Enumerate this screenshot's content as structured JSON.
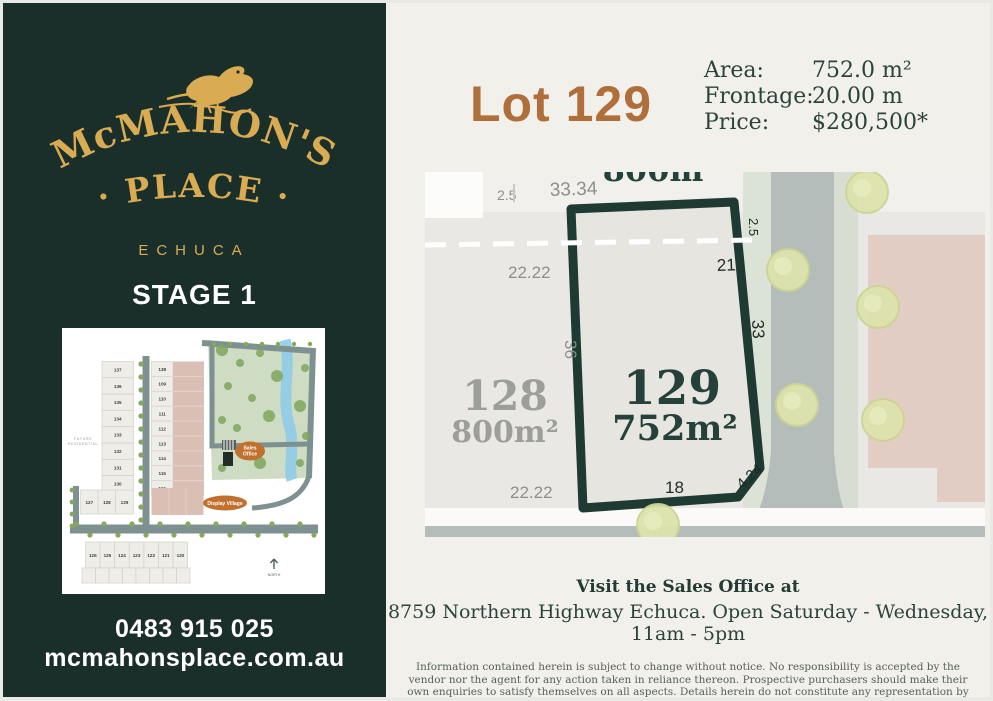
{
  "sidebar": {
    "brand": {
      "name_arc": "McMAHON'S",
      "name_line2": "· PLACE ·",
      "location": "ECHUCA"
    },
    "stage_label": "STAGE 1",
    "phone": "0483 915 025",
    "website": "mcmahonsplace.com.au",
    "minimap": {
      "left_column_lots": [
        "137",
        "136",
        "135",
        "134",
        "133",
        "132",
        "131",
        "130"
      ],
      "right_column_lots": [
        "138",
        "109",
        "110",
        "111",
        "112",
        "113",
        "114",
        "115",
        "116"
      ],
      "row_lots": [
        "127",
        "128",
        "129"
      ],
      "bottom_row_lots": [
        "126",
        "125",
        "124",
        "123",
        "122",
        "121",
        "120"
      ],
      "sales_office_label_1": "Sales",
      "sales_office_label_2": "Office",
      "display_village_label": "Display Village",
      "future_label_1": "FUTURE",
      "future_label_2": "RESIDENTIAL",
      "north_label": "NORTH"
    }
  },
  "main": {
    "lot_title": "Lot 129",
    "details": [
      {
        "label": "Area:",
        "value": "752.0 m²"
      },
      {
        "label": "Frontage:",
        "value": "20.00 m"
      },
      {
        "label": "Price:",
        "value": "$280,500*"
      }
    ],
    "plan": {
      "lot129": {
        "number": "129",
        "area": "752m²",
        "dim_top": "21",
        "dim_right_top": "2.5",
        "dim_right": "33",
        "dim_bottom": "18",
        "dim_chamfer": "4.24",
        "dim_left": "36"
      },
      "lot128": {
        "number": "128",
        "area": "800m²",
        "dim_top": "22.22",
        "dim_bottom": "22.22"
      },
      "road_offset": "2.5",
      "road_frontage": "33.34",
      "adjacent_lot_partial_label": "800m²"
    },
    "footer": {
      "visit_heading": "Visit the Sales Office at",
      "address_line": "8759 Northern Highway Echuca. Open Saturday - Wednesday, 11am - 5pm",
      "disclaimer": "Information contained herein is subject to change without notice. No responsibility is accepted by the vendor nor the agent for any action taken in reliance thereon. Prospective purchasers should make their own enquiries to satisfy themselves on all aspects. Details herein do not constitute any representation by the vendor or the agent and are expressly excluded from any contract."
    }
  },
  "colors": {
    "sidebar_green": "#1b2f2a",
    "gold": "#d9ab52",
    "cream": "#f2f0eb",
    "lot_title_brown": "#b06f3a",
    "plan_outline_green": "#1f3a32",
    "road_gray": "#b5bdba",
    "verge_green": "#dbe2d6",
    "pink_lot": "#e2cdc5",
    "badge_orange": "#c2702e",
    "creek_blue": "#8ecbe8"
  }
}
